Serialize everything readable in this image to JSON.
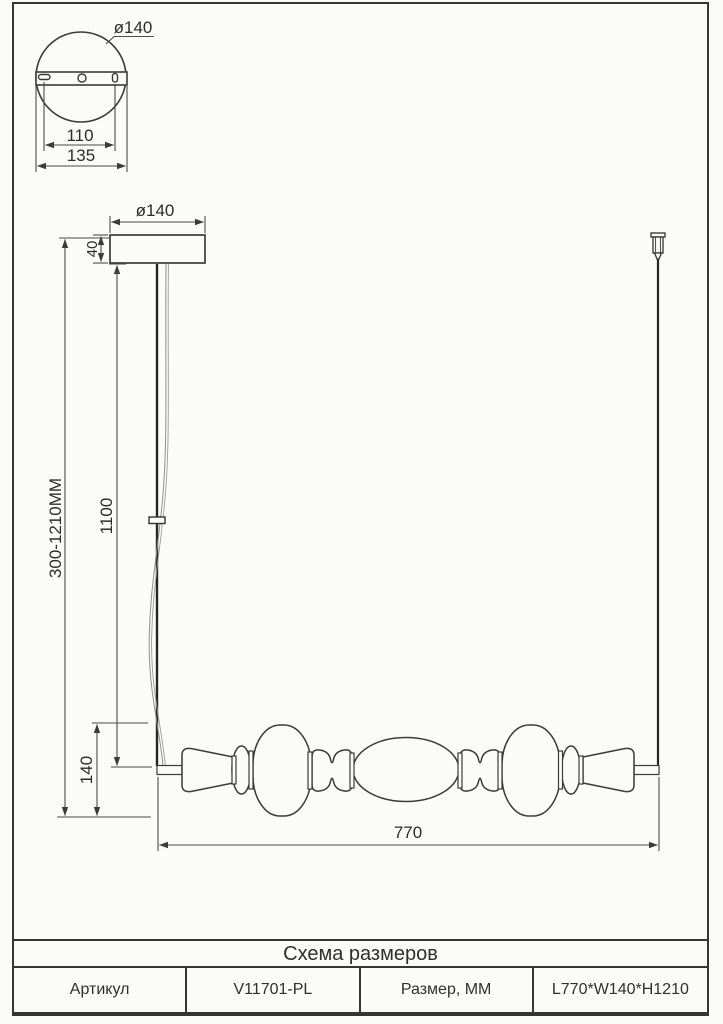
{
  "colors": {
    "line": "#3b3b3b",
    "dim_line": "#4a4a4a",
    "text": "#2c2c2c",
    "background": "#fbfbfa"
  },
  "top_view": {
    "diameter": "ø140",
    "hole_spacing": "110",
    "plate_width": "135"
  },
  "front_view": {
    "canopy_diameter": "ø140",
    "canopy_height": "40",
    "height_range": "300-1210MM",
    "rod_length": "1100",
    "body_height": "140",
    "body_length": "770"
  },
  "table": {
    "title": "Схема размеров",
    "article_label": "Артикул",
    "article_value": "V11701-PL",
    "size_label": "Размер, ММ",
    "size_value": "L770*W140*H1210"
  }
}
